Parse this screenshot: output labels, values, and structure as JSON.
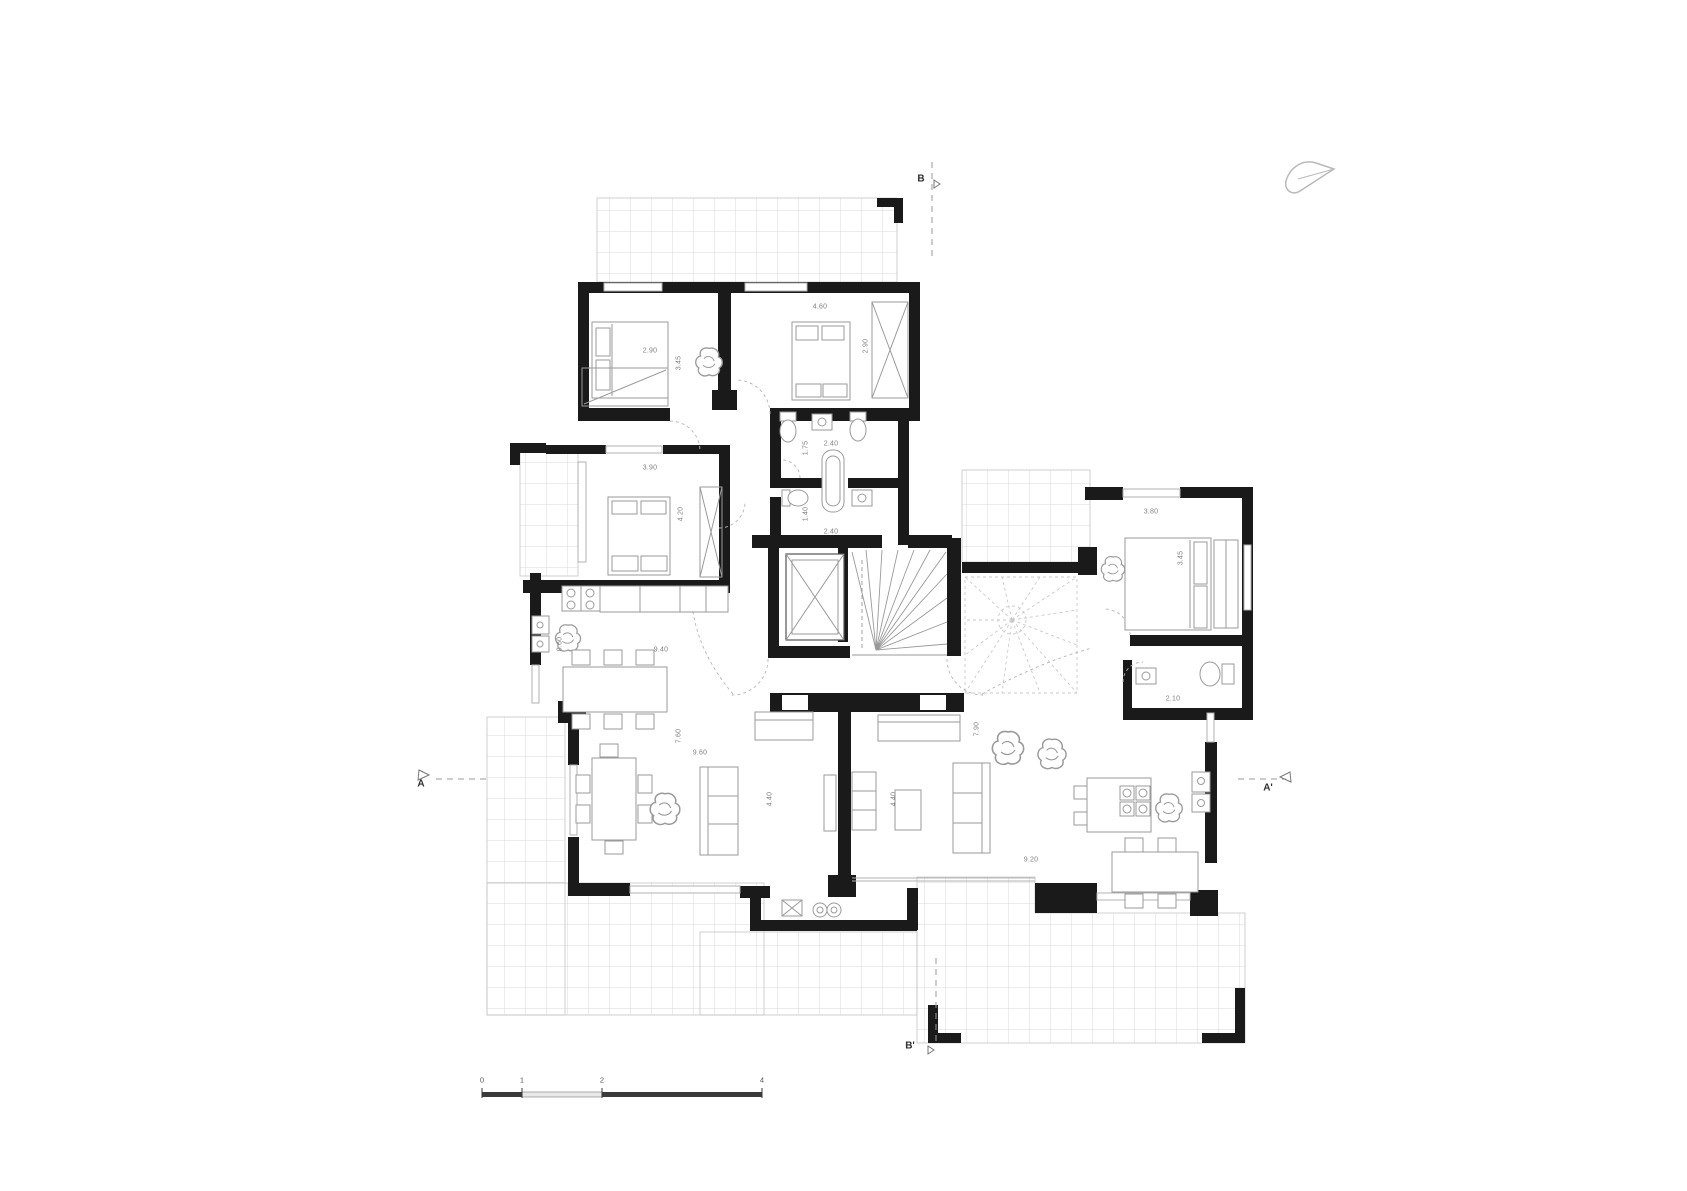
{
  "page": {
    "background_color": "#ffffff"
  },
  "plan": {
    "type": "architectural floor plan, two residential units with central stair core",
    "units": "meters",
    "colors": {
      "wall": "#1a1a1a",
      "furniture_line": "#9a9a9a",
      "terrace_grid": "#d9d9d9",
      "terrace_border": "#c4c4c4",
      "window_line": "#b0b0b0",
      "dimension_text": "#808080",
      "marker_text": "#2e2e2e",
      "dashed_line": "#b5b5b5",
      "north_arrow": "#b9b9b9",
      "scale_dark": "#3a3a3a",
      "scale_light": "#e8e8e8"
    },
    "icons": {
      "north_arrow": "north-arrow-icon"
    },
    "section_markers": [
      {
        "label": "B",
        "x": 921,
        "y": 179
      },
      {
        "label": "B'",
        "x": 910,
        "y": 1046
      },
      {
        "label": "A",
        "x": 421,
        "y": 784
      },
      {
        "label": "A'",
        "x": 1268,
        "y": 788
      }
    ],
    "scale_bar": {
      "tick_labels": [
        "0",
        "1",
        "2",
        "4"
      ],
      "tick_x": [
        482,
        522,
        602,
        762
      ],
      "label_y": 1080
    },
    "dimensions": [
      {
        "t": "4.60",
        "x": 820,
        "y": 307,
        "r": 0
      },
      {
        "t": "2.90",
        "x": 650,
        "y": 351,
        "r": 0
      },
      {
        "t": "3.45",
        "x": 679,
        "y": 363,
        "r": 90
      },
      {
        "t": "2.90",
        "x": 866,
        "y": 346,
        "r": 90
      },
      {
        "t": "3.90",
        "x": 650,
        "y": 468,
        "r": 0
      },
      {
        "t": "4.20",
        "x": 681,
        "y": 514,
        "r": 90
      },
      {
        "t": "2.40",
        "x": 831,
        "y": 444,
        "r": 0
      },
      {
        "t": "1.75",
        "x": 806,
        "y": 448,
        "r": 90
      },
      {
        "t": "2.40",
        "x": 831,
        "y": 532,
        "r": 0
      },
      {
        "t": "1.40",
        "x": 806,
        "y": 514,
        "r": 90
      },
      {
        "t": "0.60",
        "x": 560,
        "y": 644,
        "r": 90
      },
      {
        "t": "9.40",
        "x": 661,
        "y": 650,
        "r": 0
      },
      {
        "t": "7.60",
        "x": 679,
        "y": 736,
        "r": 90
      },
      {
        "t": "9.60",
        "x": 700,
        "y": 753,
        "r": 0
      },
      {
        "t": "4.40",
        "x": 770,
        "y": 799,
        "r": 90
      },
      {
        "t": "4.40",
        "x": 894,
        "y": 799,
        "r": 90
      },
      {
        "t": "7.90",
        "x": 977,
        "y": 729,
        "r": 90
      },
      {
        "t": "9.20",
        "x": 1031,
        "y": 860,
        "r": 0
      },
      {
        "t": "3.80",
        "x": 1151,
        "y": 512,
        "r": 0
      },
      {
        "t": "3.45",
        "x": 1181,
        "y": 558,
        "r": 90
      },
      {
        "t": "2.10",
        "x": 1173,
        "y": 699,
        "r": 0
      }
    ]
  }
}
